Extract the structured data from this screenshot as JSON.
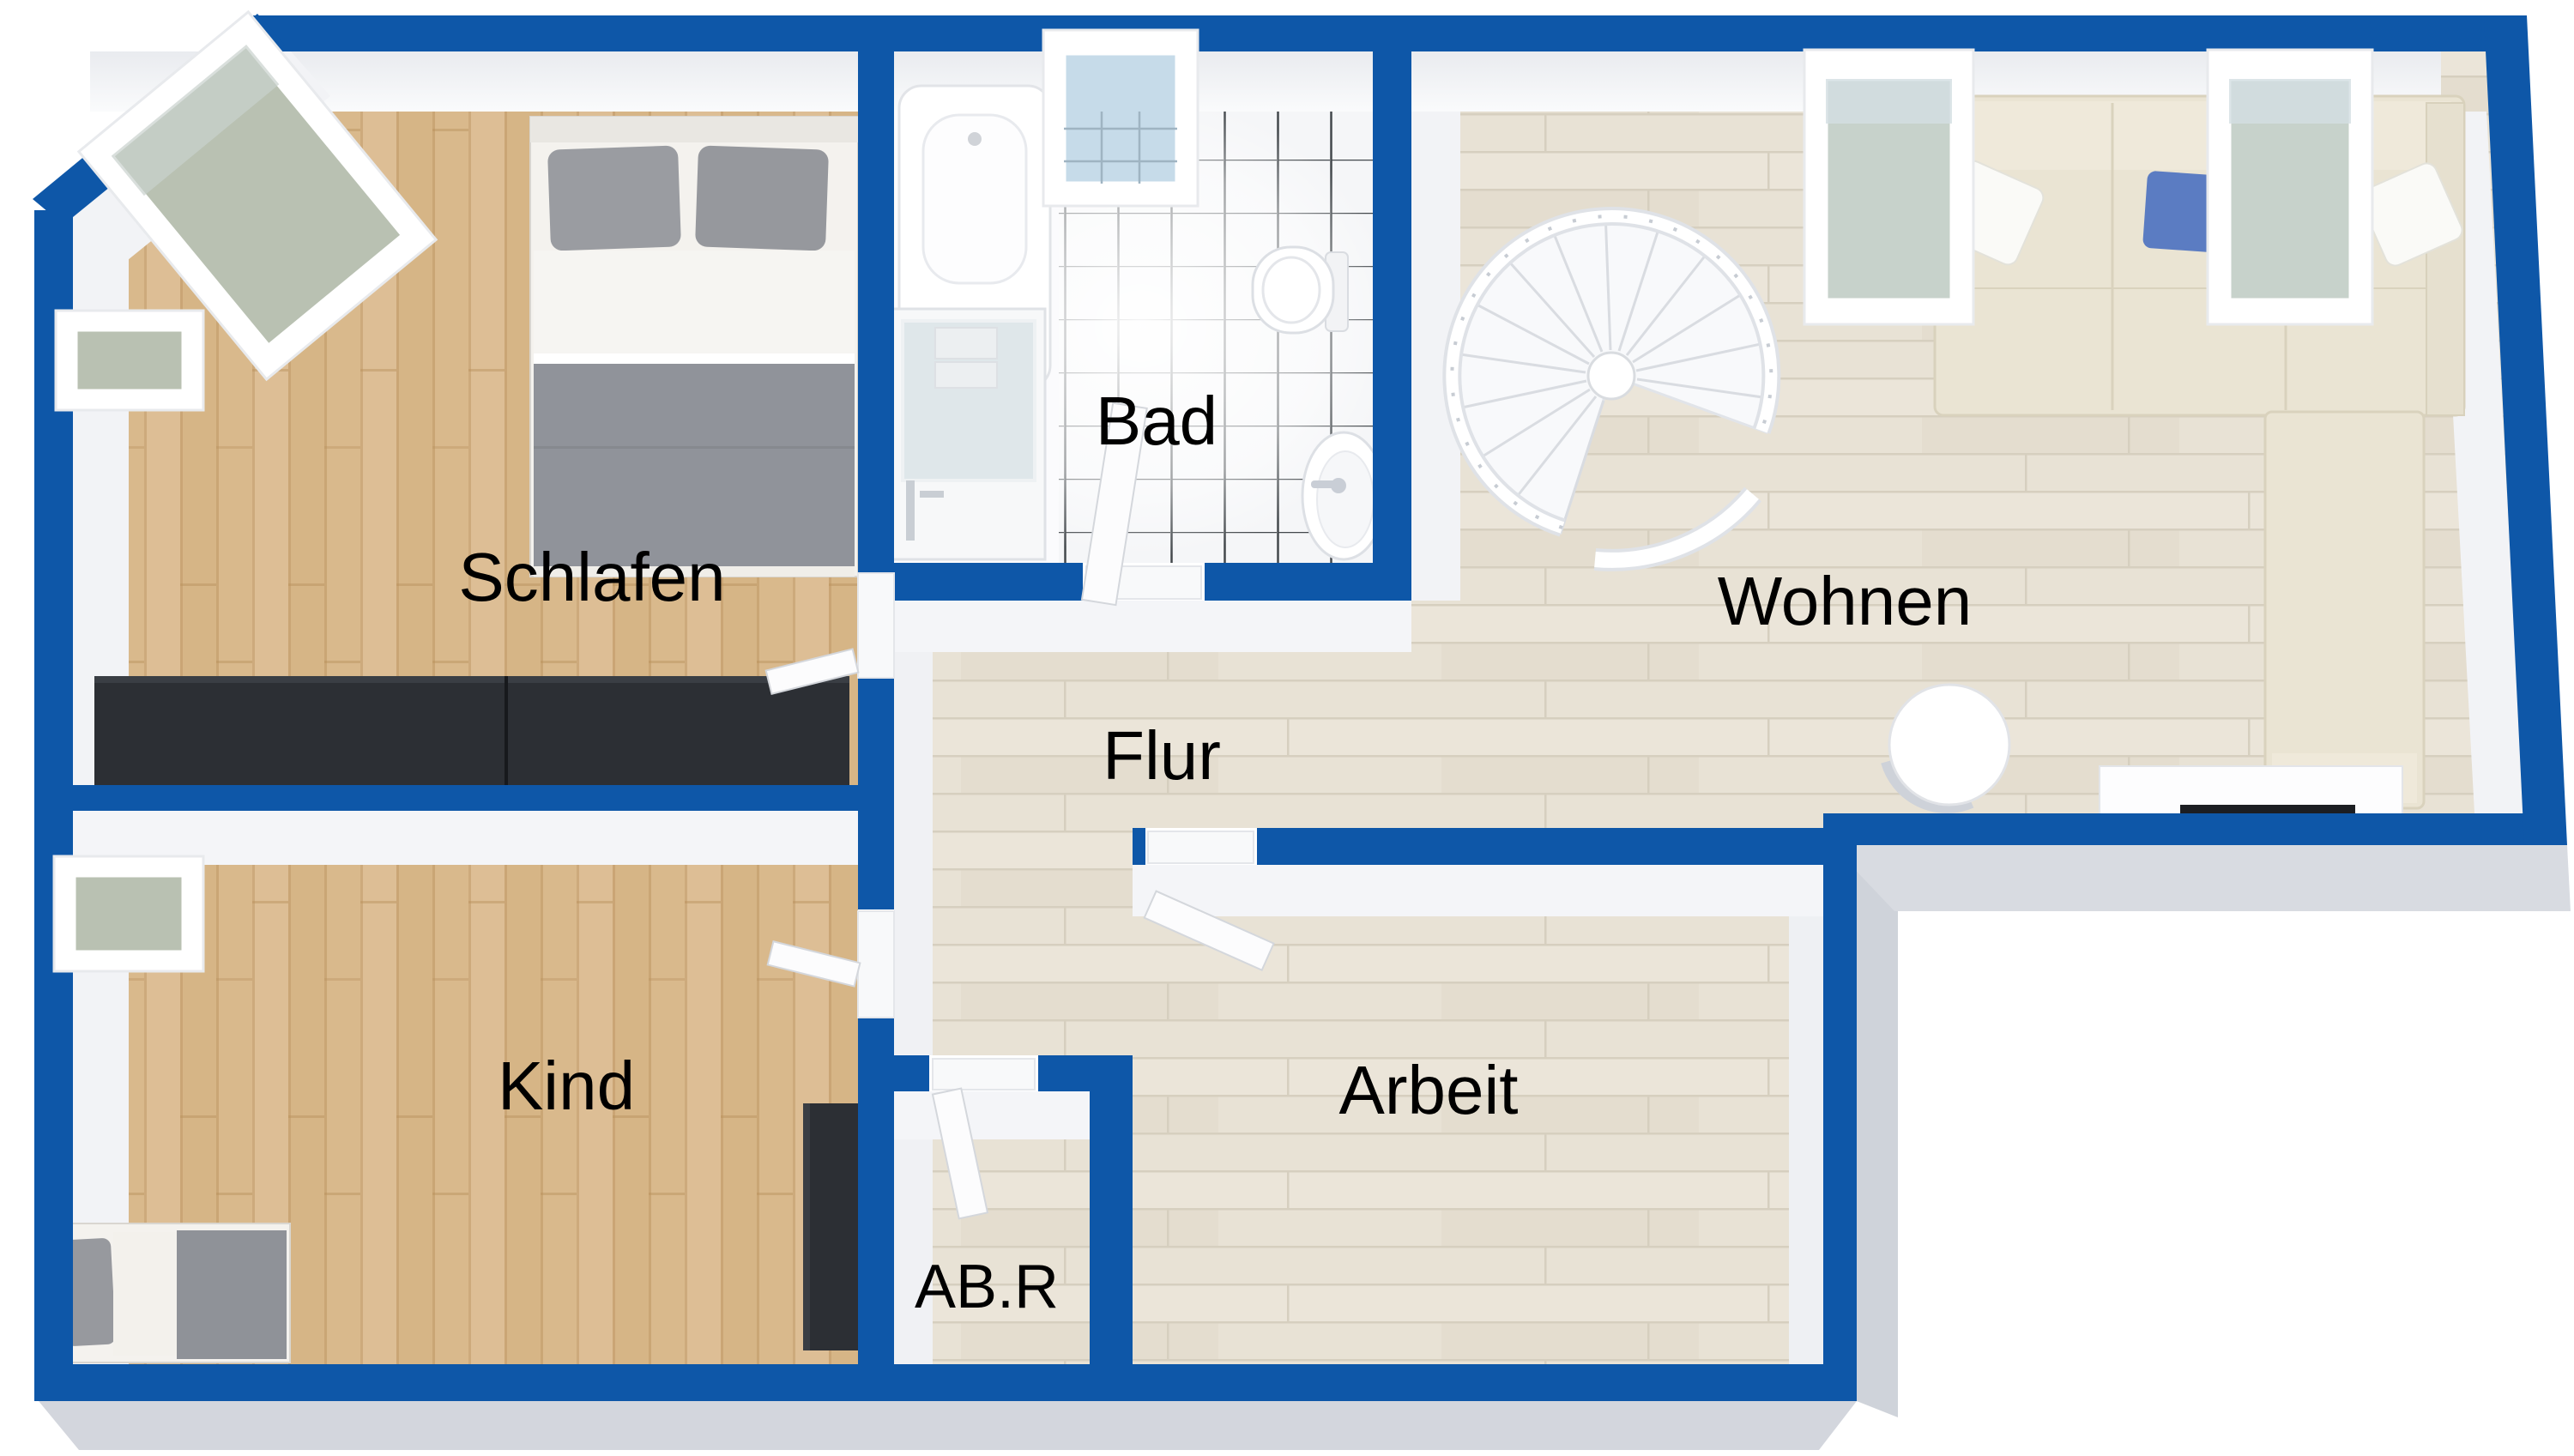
{
  "plan": {
    "kind": "3d-floor-plan-top-view",
    "style": "rendered 3D top-down apartment plan",
    "dimensions_visible": false
  },
  "rooms": {
    "schlafen": {
      "label": "Schlafen",
      "type": "bedroom",
      "floor": "oak"
    },
    "bad": {
      "label": "Bad",
      "type": "bathroom",
      "floor": "white-tiles"
    },
    "wohnen": {
      "label": "Wohnen",
      "type": "living-room",
      "floor": "whitewashed-wood"
    },
    "flur": {
      "label": "Flur",
      "type": "hallway",
      "floor": "whitewashed-wood"
    },
    "kind": {
      "label": "Kind",
      "type": "kids-room",
      "floor": "oak"
    },
    "abr": {
      "label": "AB.R",
      "type": "storage-room",
      "floor": "whitewashed-wood"
    },
    "arbeit": {
      "label": "Arbeit",
      "type": "office",
      "floor": "whitewashed-wood"
    }
  },
  "colors": {
    "wall_blue": "#0e57a8",
    "wall_face_white": "#f2f3f6",
    "outside_shadow": "#d3d6dd",
    "oak_floor": "#d9b98c",
    "light_floor": "#e8e2d5",
    "tile_grout": "#43484c",
    "dark_furniture": "#2c2f34",
    "grey_textile": "#93959a",
    "sofa_cream": "#eae4d3",
    "accent_pillow_blue": "#5b7cc2",
    "glass_green": "#b9c1b2",
    "glass_blue": "#c6dbe9",
    "label_text": "#000000"
  },
  "furniture": {
    "schlafen": [
      "double-bed",
      "wardrobe-dark",
      "skylight-window-rotated",
      "skylight-window"
    ],
    "bad": [
      "bathtub",
      "vanity-washbasin",
      "toilet",
      "small-sink",
      "skylight-window"
    ],
    "wohnen": [
      "spiral-staircase",
      "corner-sofa",
      "chaise",
      "round-side-table",
      "sideboard-tv",
      "skylight-window",
      "skylight-window"
    ],
    "kind": [
      "single-bed",
      "desk-dark",
      "skylight-window"
    ],
    "arbeit": [
      "skylight-window"
    ]
  },
  "windows": {
    "skylights_total": 6
  },
  "doors": [
    "schlafen-door",
    "kind-door",
    "bad-door",
    "abr-door",
    "arbeit-door"
  ]
}
